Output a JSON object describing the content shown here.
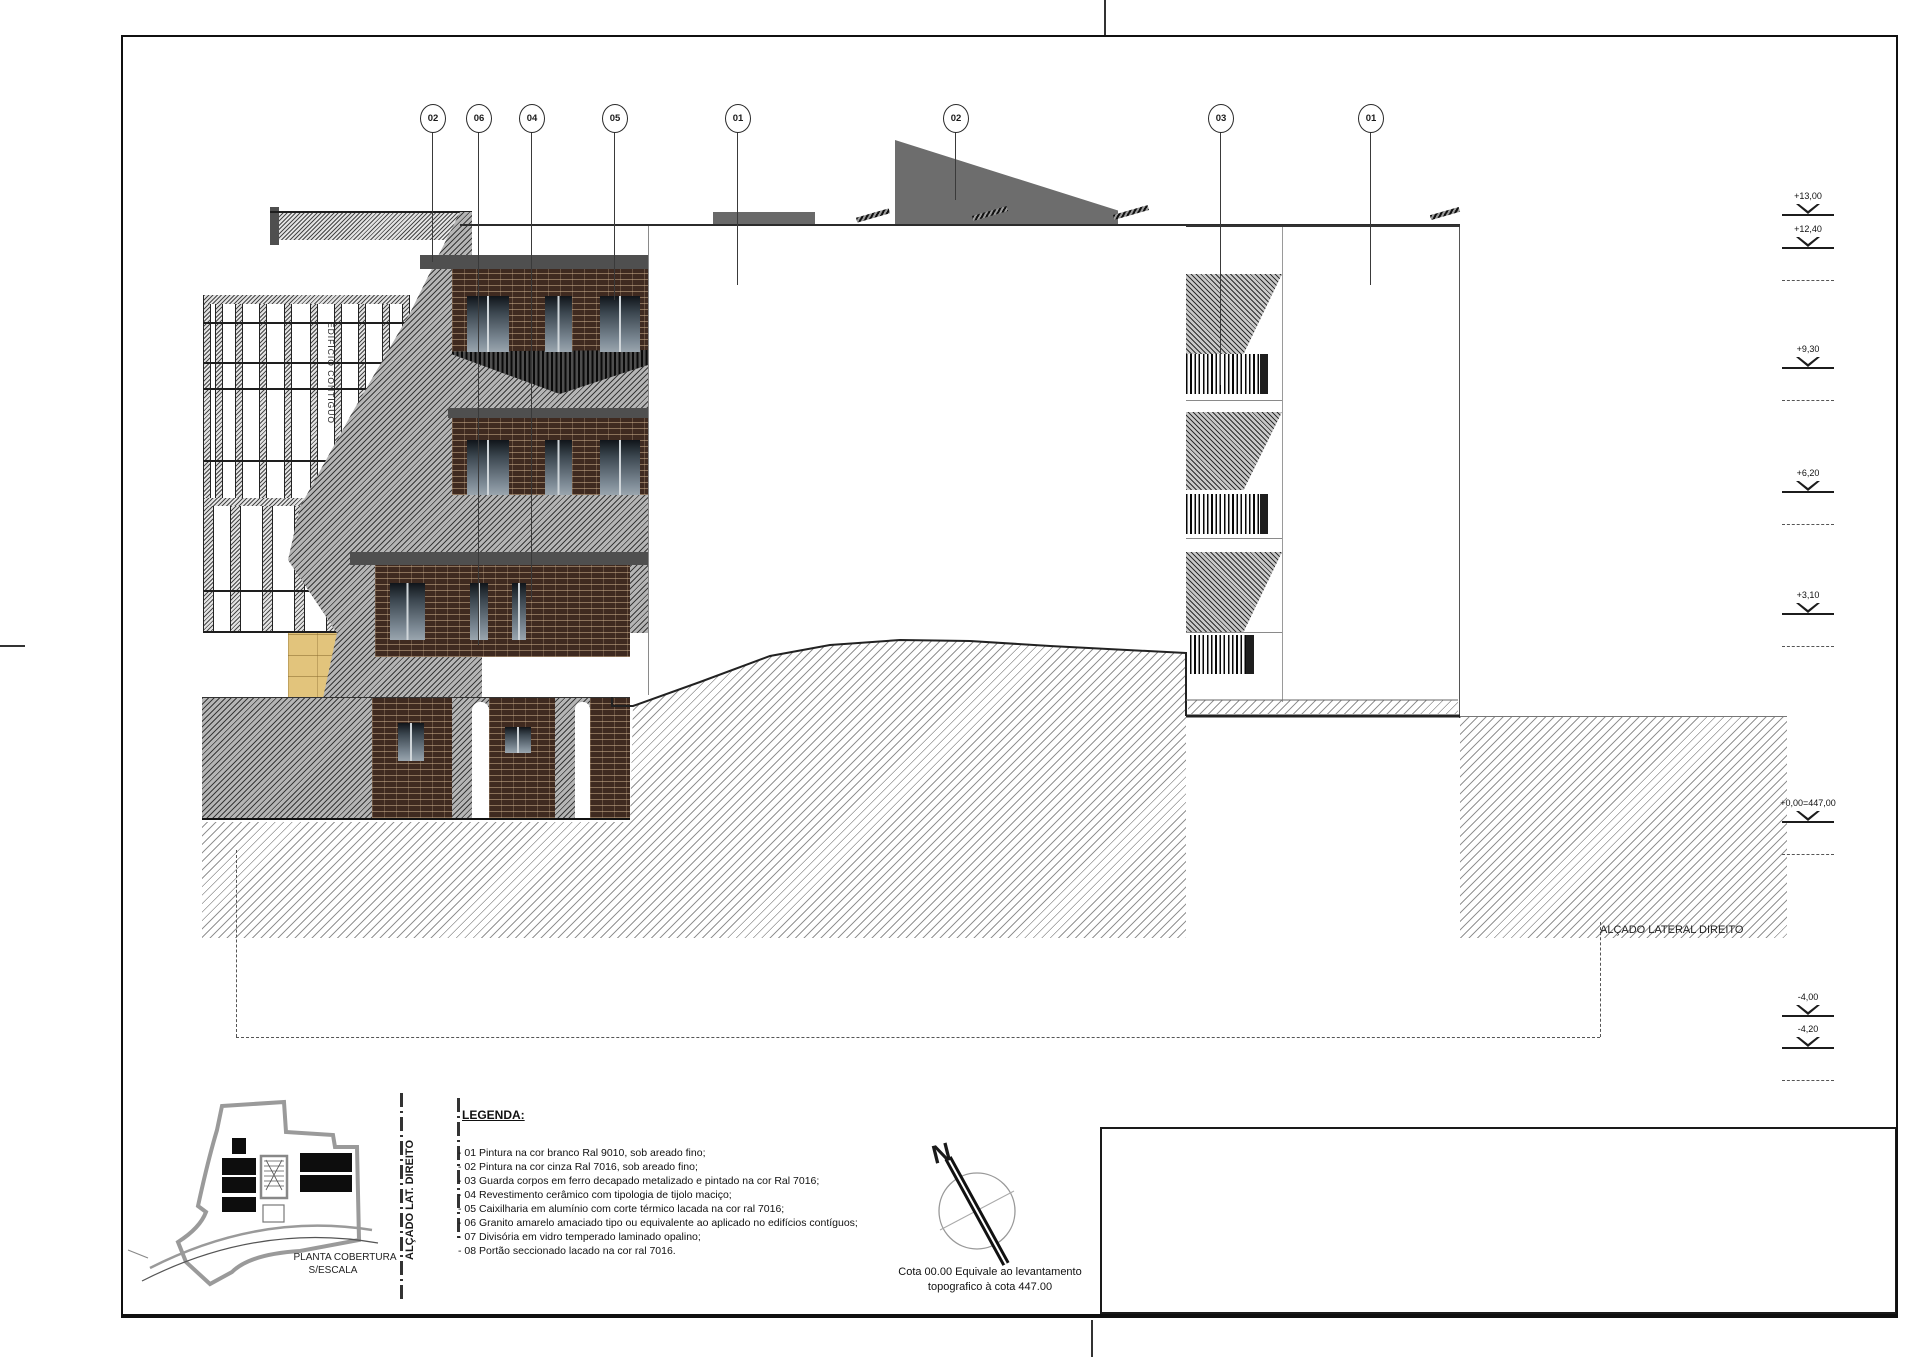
{
  "drawing": {
    "elevation_title": "ALÇADO LATERAL DIREITO",
    "adjacent_building_label": "EDIFÍCIO CONTÍGUO"
  },
  "callouts": {
    "labels": [
      "02",
      "06",
      "04",
      "05",
      "01",
      "02",
      "03",
      "01"
    ]
  },
  "elevation_markers": {
    "labels": [
      "+13,00",
      "+12,40",
      "+9,30",
      "+6,20",
      "+3,10",
      "+0,00=447,00",
      "-4,00",
      "-4,20"
    ]
  },
  "legend": {
    "title": "LEGENDA:",
    "items": [
      "- 01 Pintura na cor branco Ral 9010, sob areado fino;",
      "- 02 Pintura na cor cinza Ral 7016, sob areado fino;",
      "- 03 Guarda corpos em ferro decapado metalizado e pintado na cor Ral 7016;",
      "- 04 Revestimento cerâmico com tipologia de tijolo maciço;",
      "- 05 Caixilharia em alumínio com corte térmico lacada na cor ral 7016;",
      "- 06 Granito amarelo amaciado tipo ou equivalente ao aplicado no edifícios contíguos;",
      "- 07 Divisória em vidro temperado laminado opalino;",
      "- 08 Portão seccionado lacado na cor ral 7016."
    ]
  },
  "compass": {
    "north_label": "N",
    "note_line1": "Cota 00.00 Equivale ao levantamento",
    "note_line2": "topografico à cota 447.00"
  },
  "site_plan": {
    "caption_line1": "PLANTA COBERTURA",
    "caption_line2": "S/ESCALA",
    "section_label": "ALÇADO LAT. DIREITO"
  },
  "colors": {
    "roof_gray": "#6d6d6d",
    "granite_yellow": "#e2c47c",
    "brick_brown": "#3f2a20",
    "line_dark": "#1a1a1a"
  }
}
